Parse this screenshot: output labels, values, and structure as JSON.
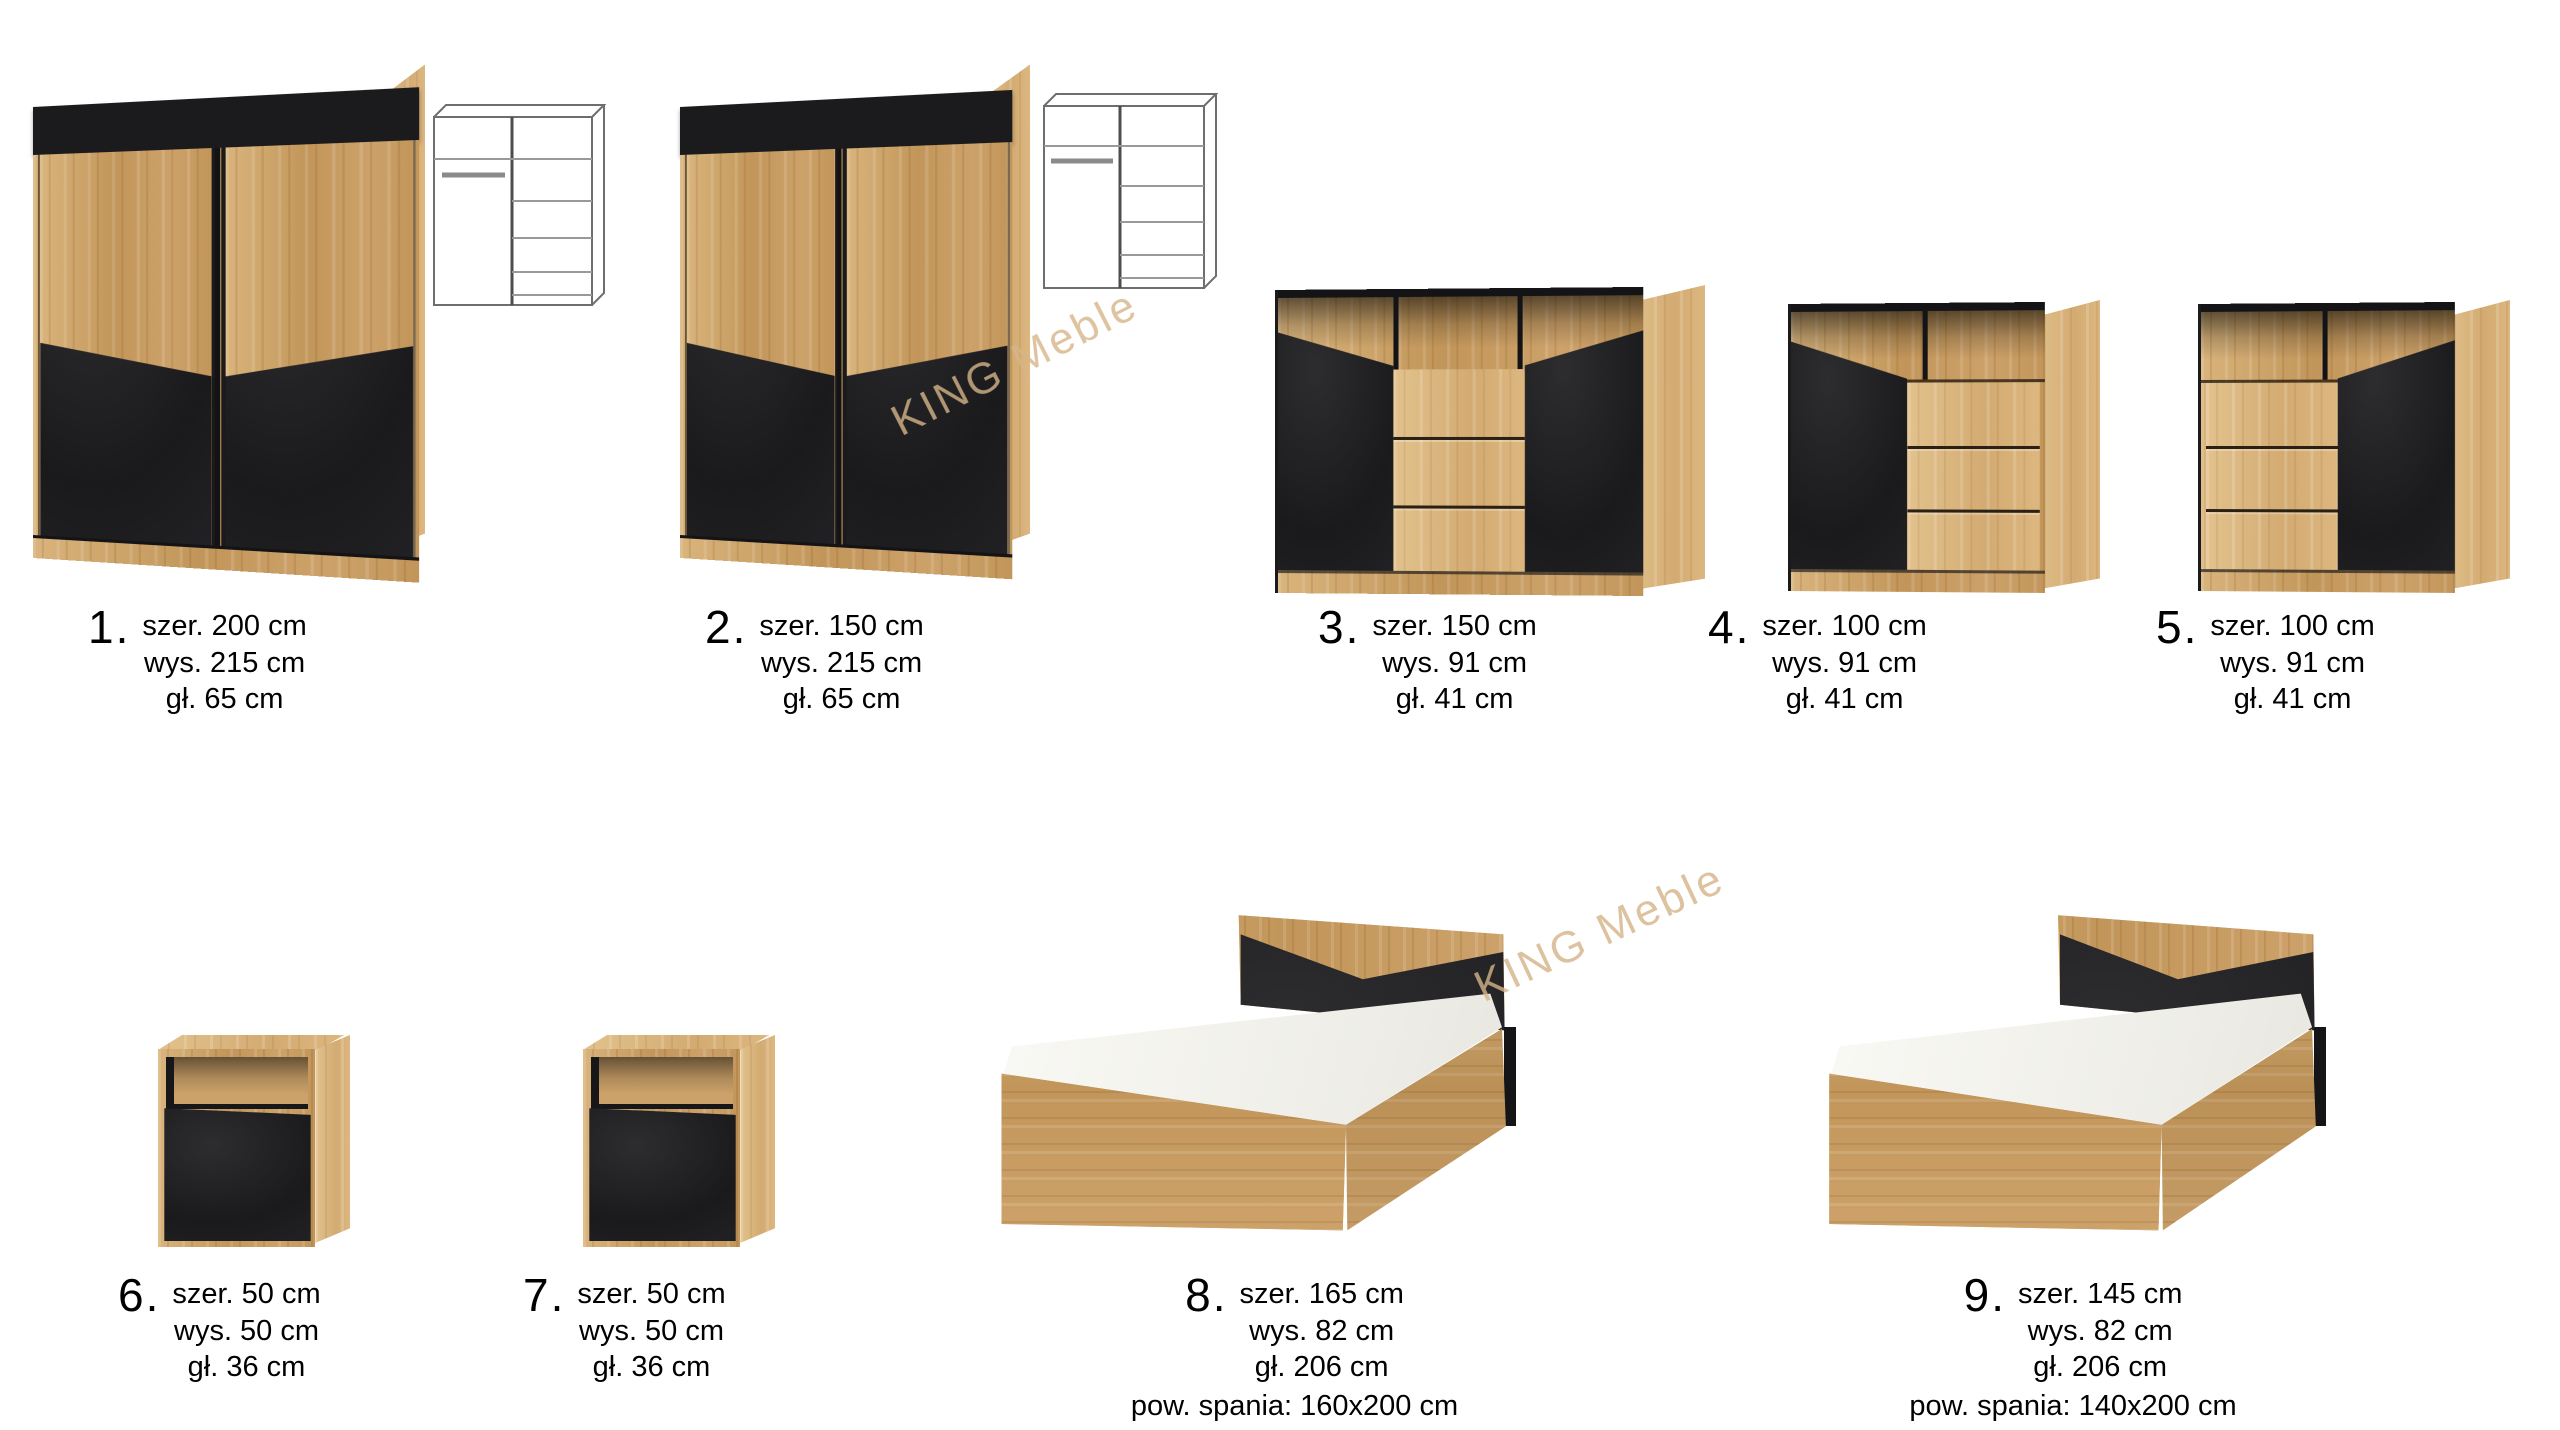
{
  "page": {
    "background": "#ffffff"
  },
  "colors": {
    "wood": "#cda26a",
    "wood_dark": "#c2965a",
    "black_front": "#1d1d1f",
    "watermark": "#d5b488",
    "label_text": "#000000"
  },
  "watermarks": [
    {
      "text": "KING Meble"
    },
    {
      "text": "KING Meble"
    }
  ],
  "products": [
    {
      "number": "1.",
      "type": "sliding-wardrobe",
      "dims": [
        "szer. 200 cm",
        "wys. 215 cm",
        "gł. 65 cm"
      ]
    },
    {
      "number": "2.",
      "type": "sliding-wardrobe",
      "dims": [
        "szer. 150 cm",
        "wys. 215 cm",
        "gł. 65 cm"
      ]
    },
    {
      "number": "3.",
      "type": "sideboard-2-doors-3-drawers",
      "dims": [
        "szer. 150 cm",
        "wys. 91 cm",
        "gł. 41 cm"
      ]
    },
    {
      "number": "4.",
      "type": "chest-door-left",
      "dims": [
        "szer. 100 cm",
        "wys. 91 cm",
        "gł. 41 cm"
      ]
    },
    {
      "number": "5.",
      "type": "chest-door-right",
      "dims": [
        "szer. 100 cm",
        "wys. 91 cm",
        "gł. 41 cm"
      ]
    },
    {
      "number": "6.",
      "type": "nightstand",
      "dims": [
        "szer. 50 cm",
        "wys. 50 cm",
        "gł. 36 cm"
      ]
    },
    {
      "number": "7.",
      "type": "nightstand",
      "dims": [
        "szer. 50 cm",
        "wys. 50 cm",
        "gł. 36 cm"
      ]
    },
    {
      "number": "8.",
      "type": "bed",
      "dims": [
        "szer. 165 cm",
        "wys. 82 cm",
        "gł. 206 cm",
        "pow. spania: 160x200 cm"
      ]
    },
    {
      "number": "9.",
      "type": "bed",
      "dims": [
        "szer. 145 cm",
        "wys. 82 cm",
        "gł. 206 cm",
        "pow. spania: 140x200 cm"
      ]
    }
  ]
}
